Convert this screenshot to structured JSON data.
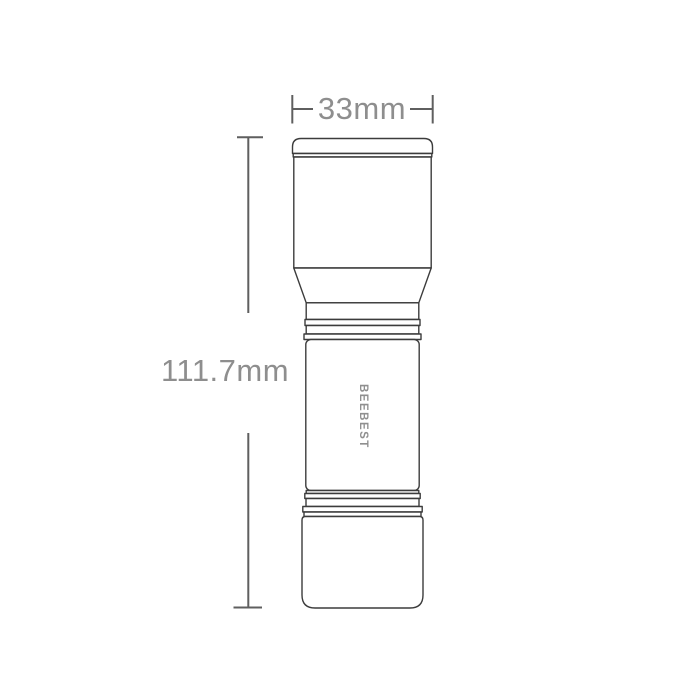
{
  "diagram": {
    "kind": "flashlight-dimension-drawing",
    "brand_label": "BEEBEST",
    "width_dimension": {
      "label": "33mm"
    },
    "height_dimension": {
      "label": "111.7mm"
    }
  },
  "colors": {
    "background": "#ffffff",
    "product_outline": "#3c3c3c",
    "dimension_line": "#5f5f5f",
    "dimension_text": "#8e8e8e",
    "brand_text": "#8f8f8f"
  }
}
